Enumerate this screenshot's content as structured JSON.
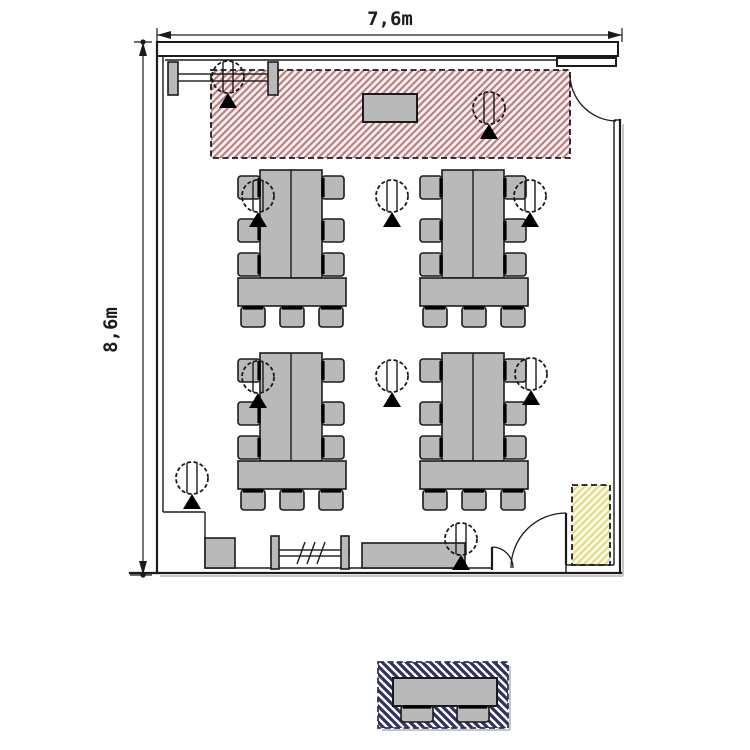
{
  "dimensions": {
    "width_label": "7,6m",
    "height_label": "8,6m"
  },
  "zones": {
    "front_zone": {
      "hatch_color": "red",
      "direction": "/",
      "border": "dashed"
    },
    "corner_zone": {
      "hatch_color": "yellow",
      "direction": "/",
      "border": "dashed"
    },
    "detail_zone": {
      "hatch_color": "blue",
      "direction": "\\",
      "border": "dashed"
    }
  },
  "furniture": {
    "student_table_groups": 4,
    "seats_per_group": 9,
    "teacher_desk": 1,
    "wall_board": 1,
    "radiator": 1,
    "cabinets": 2,
    "light_fixtures": 10,
    "detail_table_seats": 2,
    "doors": 2
  },
  "icons": {
    "light_fixture": "dashed-circle-with-vertical-bars-and-black-triangle"
  },
  "colors": {
    "line": "#1b1b1b",
    "furniture-fill": "#b9b9b9",
    "paper": "#ffffff",
    "red-bg": "#fbf0f0",
    "red-line": "#bb8083",
    "yellow-bg": "#fdfbe6",
    "yellow-line": "#e4da8e",
    "blue-line": "#31325f",
    "shadow": "#c6c6c6"
  }
}
